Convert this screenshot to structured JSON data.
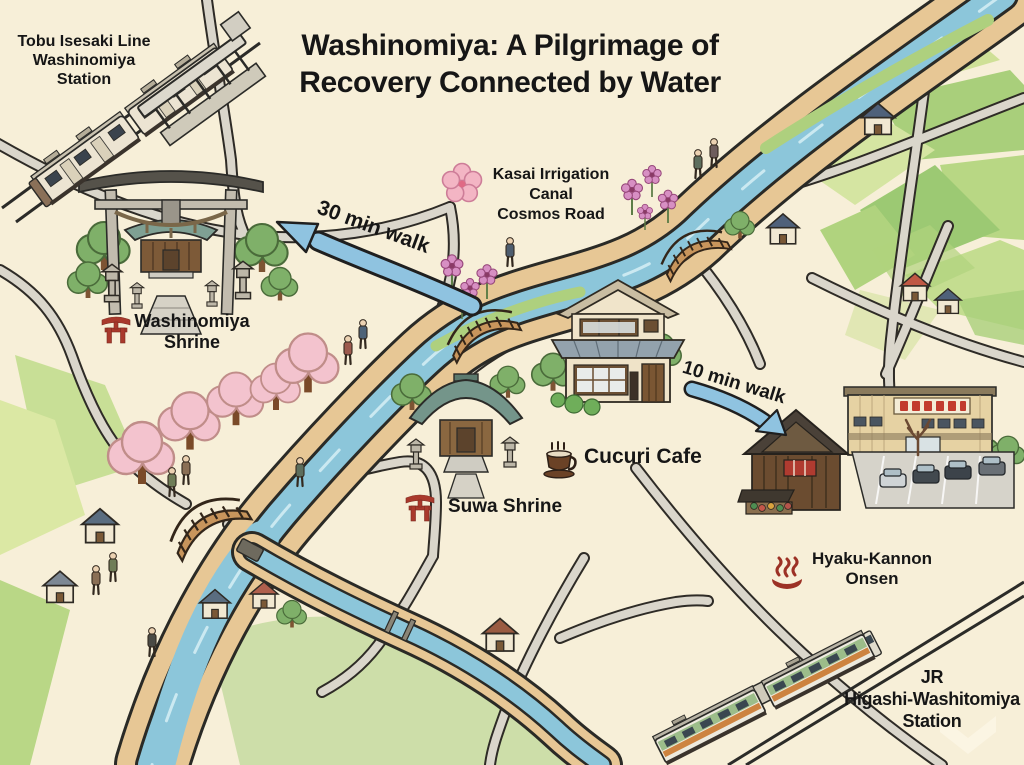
{
  "title": "Washinomiya: A Pilgrimage of\nRecovery Connected by Water",
  "labels": {
    "tobu_station": "Tobu Isesaki Line\nWashinomiya\nStation",
    "washinomiya_shrine": "Washinomiya\nShrine",
    "walk_30": "30 min walk",
    "kasai_canal": "Kasai Irrigation\nCanal\nCosmos Road",
    "suwa_shrine": "Suwa Shrine",
    "cucuri_cafe": "Cucuri Cafe",
    "walk_10": "10 min walk",
    "hyaku_kannon_onsen": "Hyaku-Kannon\nOnsen",
    "jr_station": "JR\nHigashi-Washitomiya\nStation"
  },
  "icons": {
    "washinomiya_shrine": "torii-icon",
    "suwa_shrine": "torii-icon",
    "kasai_canal": "cherry-blossom-icon",
    "cucuri_cafe": "coffee-cup-icon",
    "hyaku_kannon_onsen": "hot-spring-icon"
  },
  "colors": {
    "background": "#f7efd8",
    "water": "#8cc6da",
    "canal_bank": "#e7c795",
    "field_green": "#aed380",
    "road": "#d9d6cd",
    "arrow_blue": "#8fc3e0",
    "torii_red": "#a9392c",
    "text": "#161616"
  }
}
